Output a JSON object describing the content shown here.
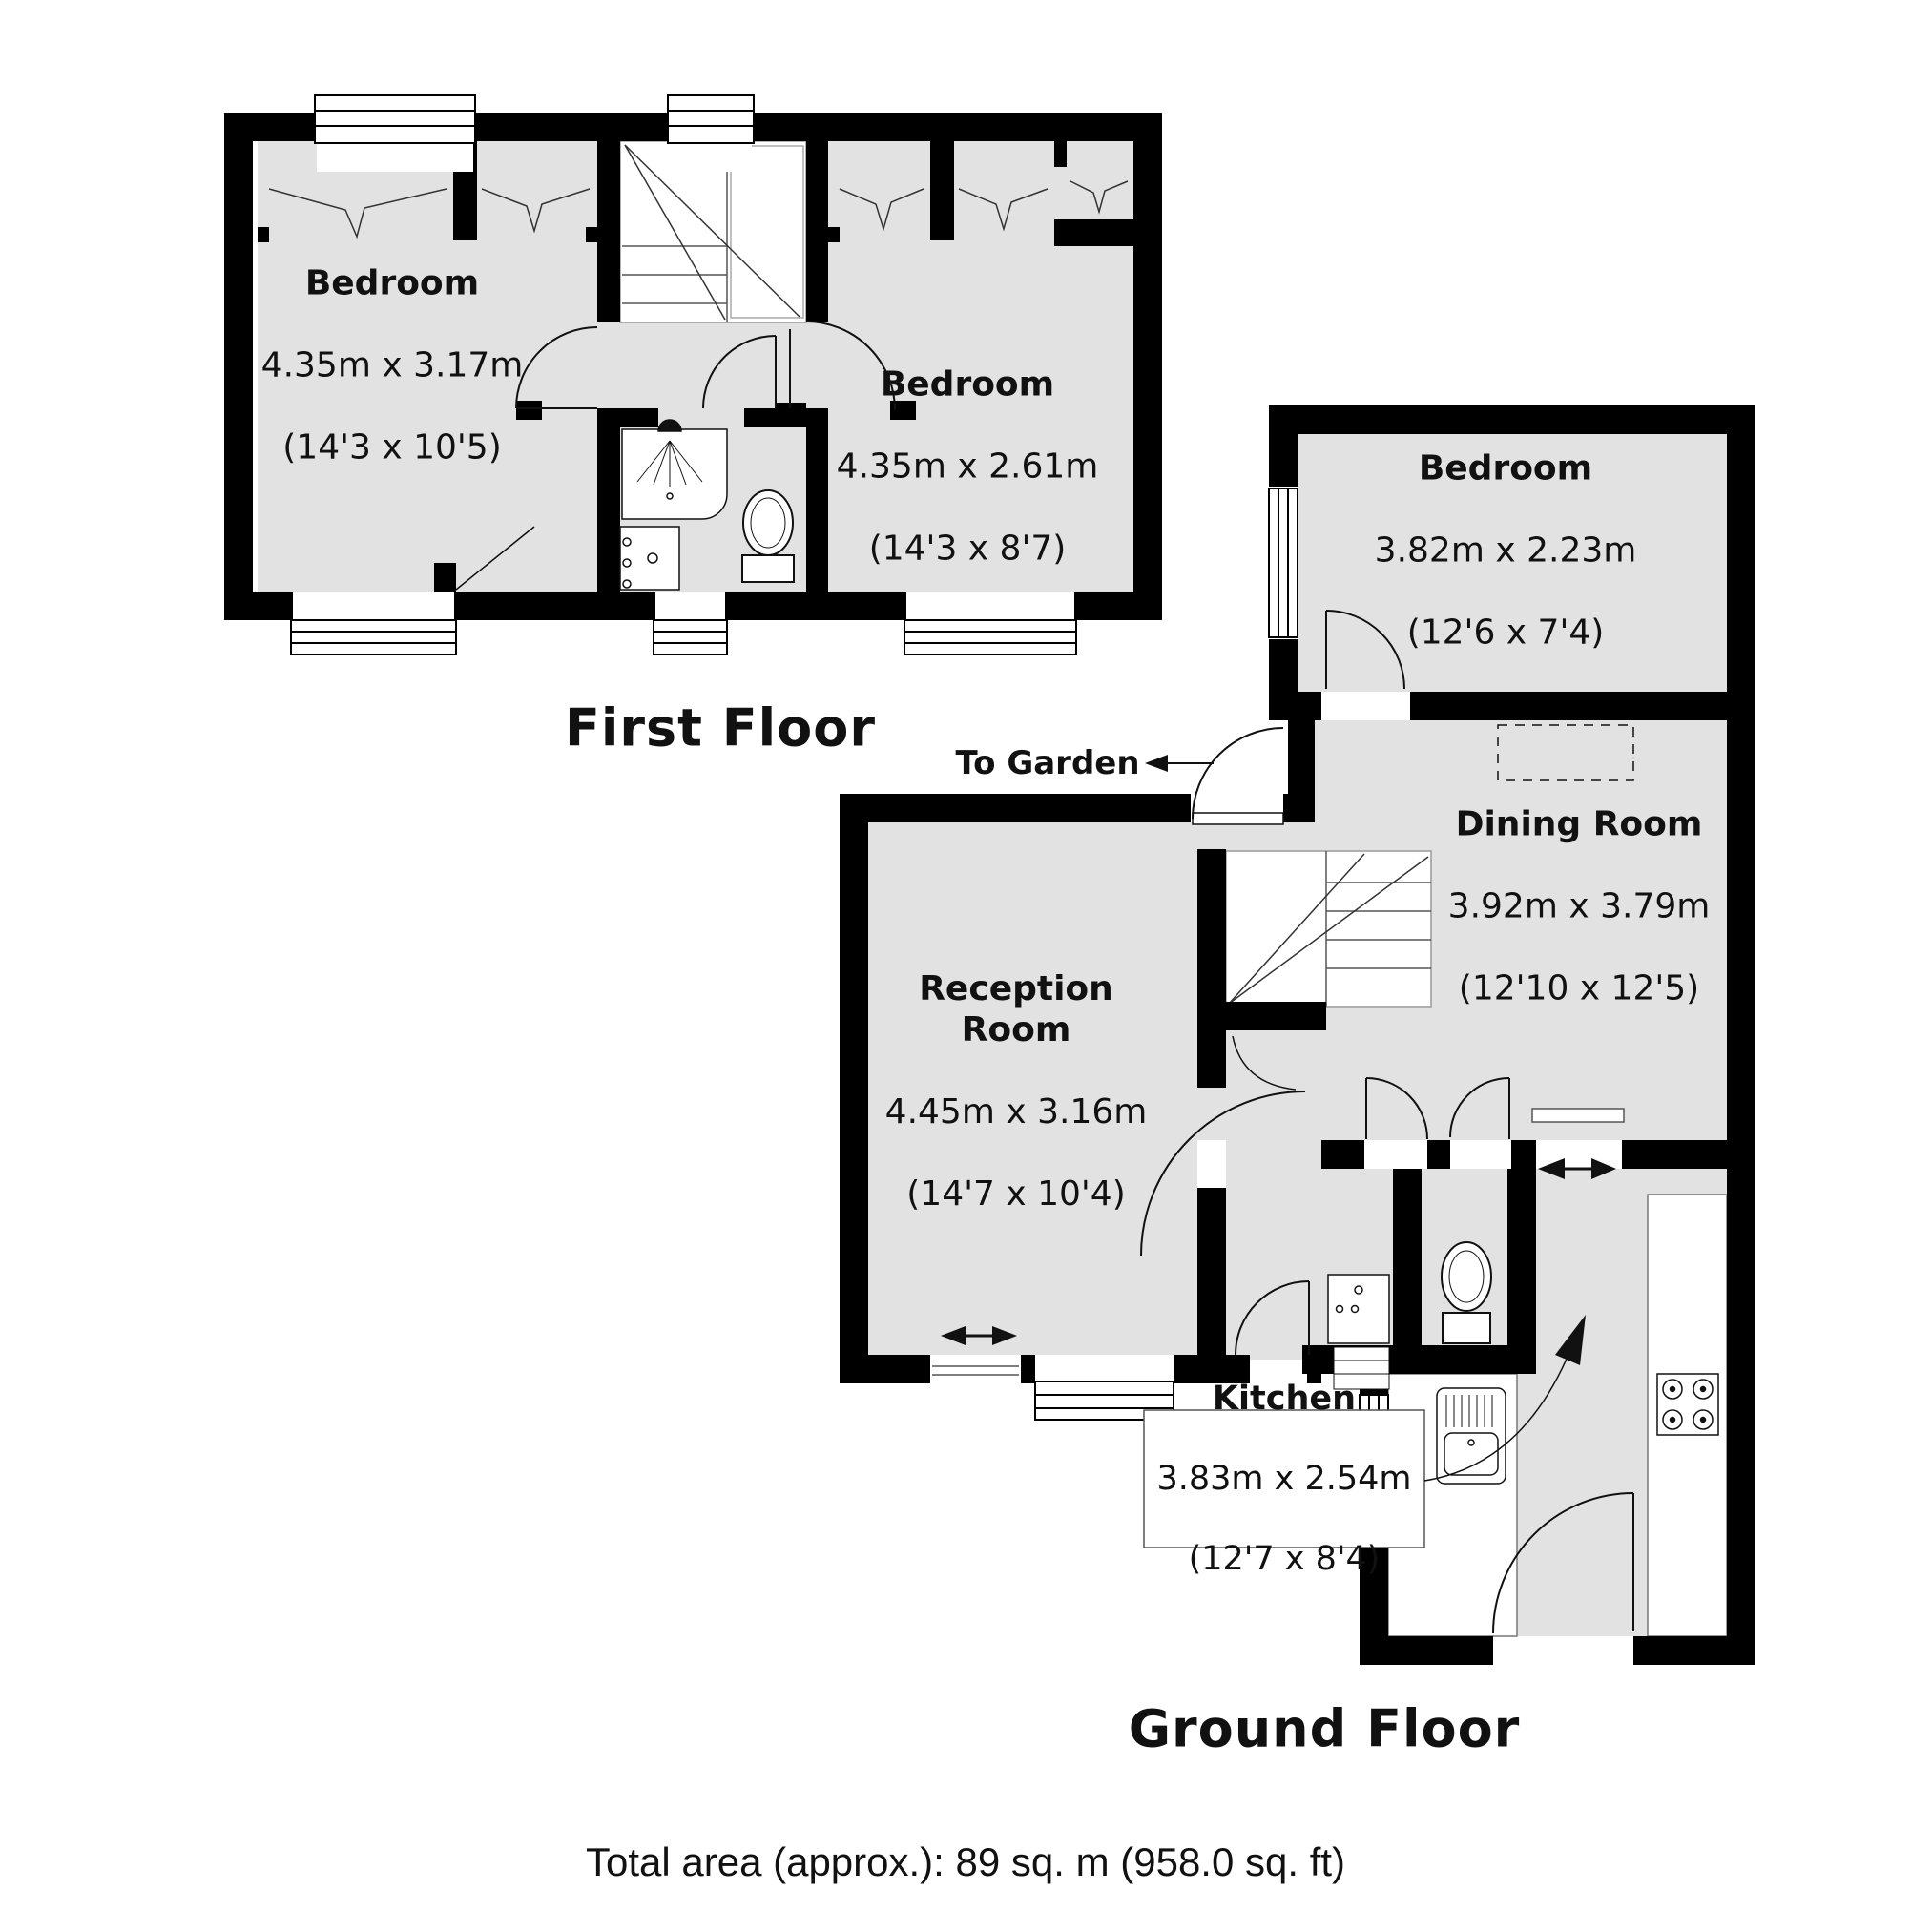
{
  "first_floor": {
    "title": "First Floor",
    "bedroom1": {
      "name": "Bedroom",
      "size_m": "4.35m x 3.17m",
      "size_ft": "(14'3 x 10'5)"
    },
    "bedroom2": {
      "name": "Bedroom",
      "size_m": "4.35m x 2.61m",
      "size_ft": "(14'3 x 8'7)"
    }
  },
  "ground_floor": {
    "title": "Ground Floor",
    "to_garden_label": "To Garden",
    "bedroom": {
      "name": "Bedroom",
      "size_m": "3.82m x 2.23m",
      "size_ft": "(12'6 x 7'4)"
    },
    "dining_room": {
      "name": "Dining Room",
      "size_m": "3.92m x 3.79m",
      "size_ft": "(12'10 x 12'5)"
    },
    "reception_room": {
      "name": "Reception\nRoom",
      "size_m": "4.45m x 3.16m",
      "size_ft": "(14'7 x 10'4)"
    },
    "kitchen": {
      "name": "Kitchen",
      "size_m": "3.83m x 2.54m",
      "size_ft": "(12'7 x 8'4)"
    }
  },
  "footer": {
    "total_area": "Total area (approx.): 89 sq. m (958.0 sq. ft)"
  },
  "colors": {
    "floor_fill": "#e2e2e2",
    "wall": "#000000",
    "line": "#111111"
  }
}
